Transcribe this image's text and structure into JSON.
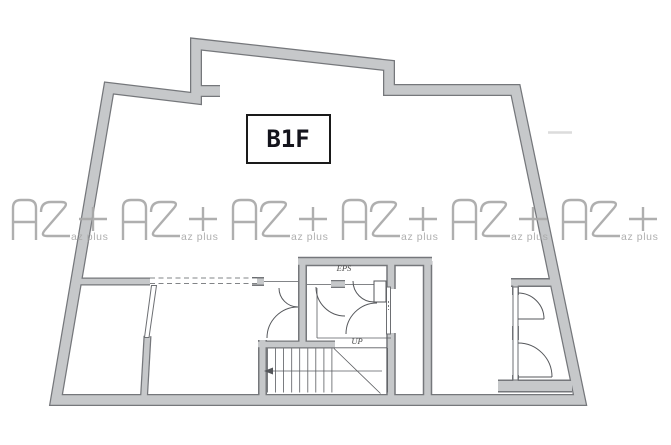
{
  "floor_plan": {
    "label": "B1F",
    "labels": {
      "shaft": "EPS",
      "stair_direction": "UP"
    },
    "watermark": {
      "logo_text": "AZ",
      "caption": "az plus",
      "count": 6
    },
    "colors": {
      "wall_fill": "#c6c8ca",
      "wall_edge": "#75777b",
      "detail_line": "#4f5054",
      "watermark_gray": "#a9a9a9",
      "floor_label_text": "#14141c",
      "annotation_text": "#4a4a4a"
    }
  }
}
